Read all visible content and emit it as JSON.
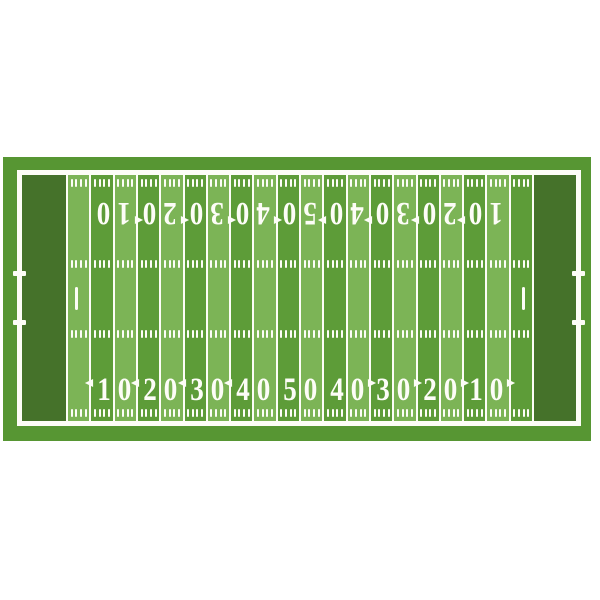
{
  "figure": {
    "type": "american-football-field-top-view",
    "colors": {
      "page_background": "#ffffff",
      "surround_green": "#579633",
      "stripe_light": "#7cb456",
      "stripe_medium": "#5d9c38",
      "end_zone_green": "#45722a",
      "line_white": "#fdfdf7"
    },
    "structure": {
      "stripe_count": 20,
      "yard_line_count": 21,
      "hash_mark_rows": 4,
      "hash_marks_per_stripe": 4,
      "end_zones": 2,
      "conversion_marks": 2,
      "sideline_ticks_per_side": 2
    },
    "yard_numbers": [
      {
        "label": "10",
        "digits": [
          "1",
          "0"
        ],
        "arrow": "left"
      },
      {
        "label": "20",
        "digits": [
          "2",
          "0"
        ],
        "arrow": "left"
      },
      {
        "label": "30",
        "digits": [
          "3",
          "0"
        ],
        "arrow": "left"
      },
      {
        "label": "40",
        "digits": [
          "4",
          "0"
        ],
        "arrow": "left"
      },
      {
        "label": "50",
        "digits": [
          "5",
          "0"
        ],
        "arrow": "none"
      },
      {
        "label": "40",
        "digits": [
          "4",
          "0"
        ],
        "arrow": "right"
      },
      {
        "label": "30",
        "digits": [
          "3",
          "0"
        ],
        "arrow": "right"
      },
      {
        "label": "20",
        "digits": [
          "2",
          "0"
        ],
        "arrow": "right"
      },
      {
        "label": "10",
        "digits": [
          "1",
          "0"
        ],
        "arrow": "right"
      }
    ]
  }
}
